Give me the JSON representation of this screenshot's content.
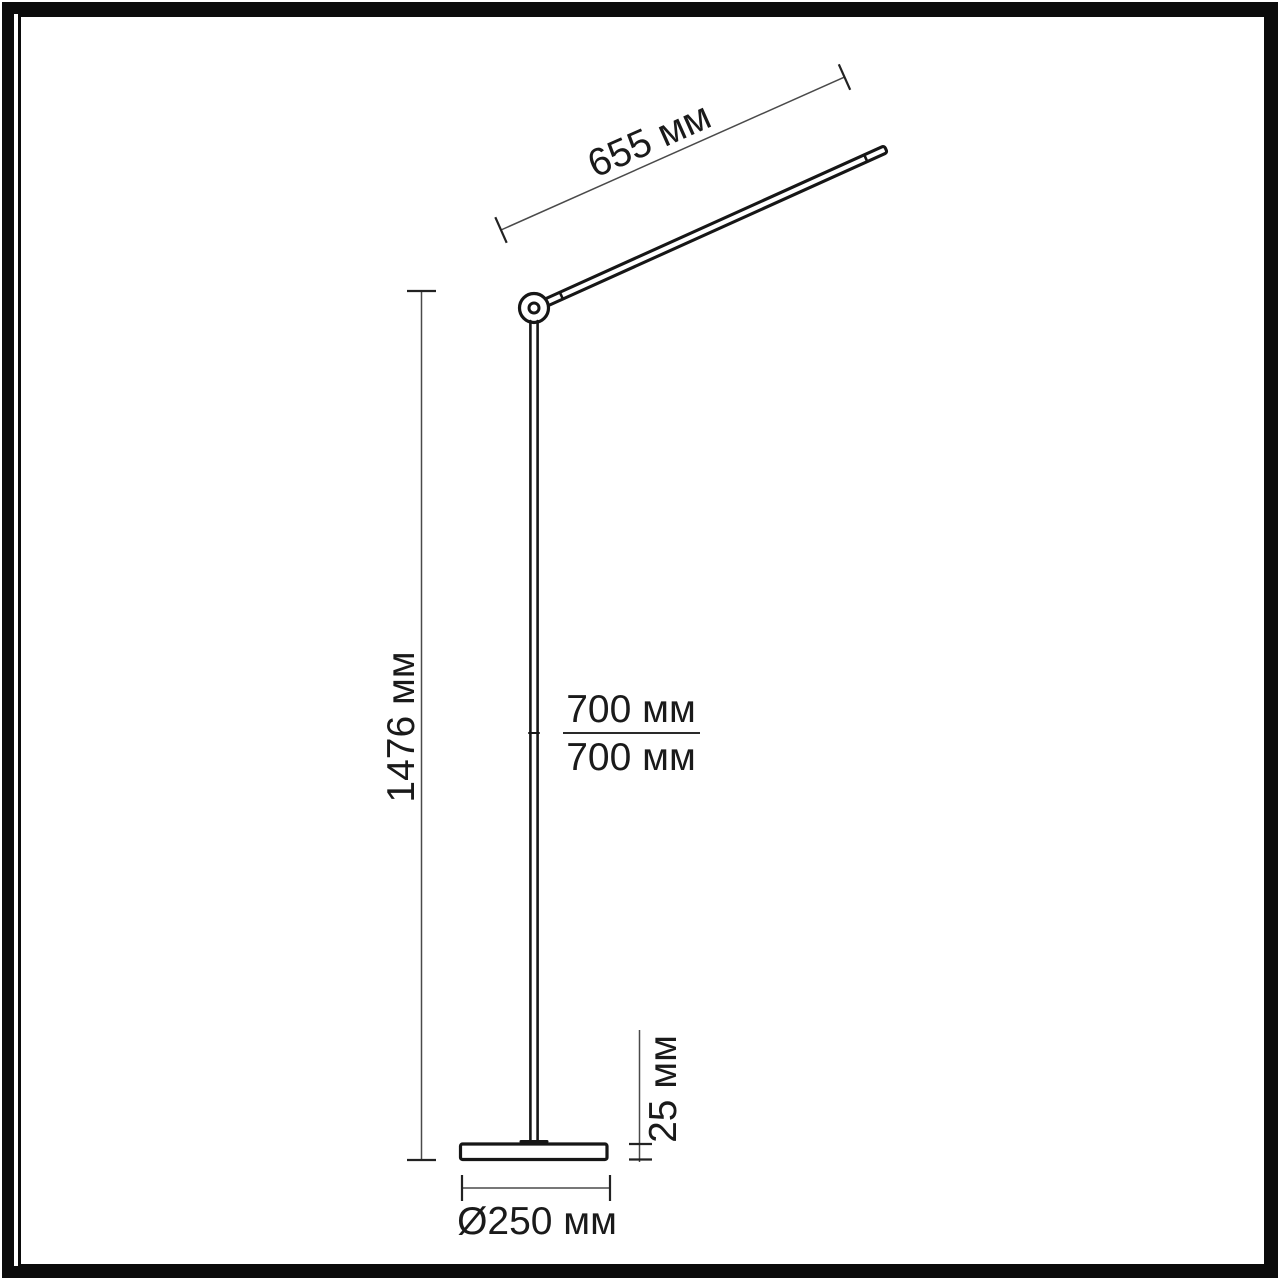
{
  "page": {
    "background": "#ffffff",
    "frame_color": "#0b0b0b",
    "line_color": "#161616",
    "dim_line_color": "#4a4a4a",
    "text_color": "#1a1a1a"
  },
  "diagram": {
    "kind": "technical dimension drawing",
    "subject": "floor lamp side elevation with pivoting arm and disc base",
    "unit": "мм",
    "labels": {
      "arm_length": "655 мм",
      "total_height": "1476 мм",
      "upper_segment": "700 мм",
      "lower_segment": "700 мм",
      "base_thickness": "25 мм",
      "base_diameter": "Ø250 мм"
    }
  }
}
